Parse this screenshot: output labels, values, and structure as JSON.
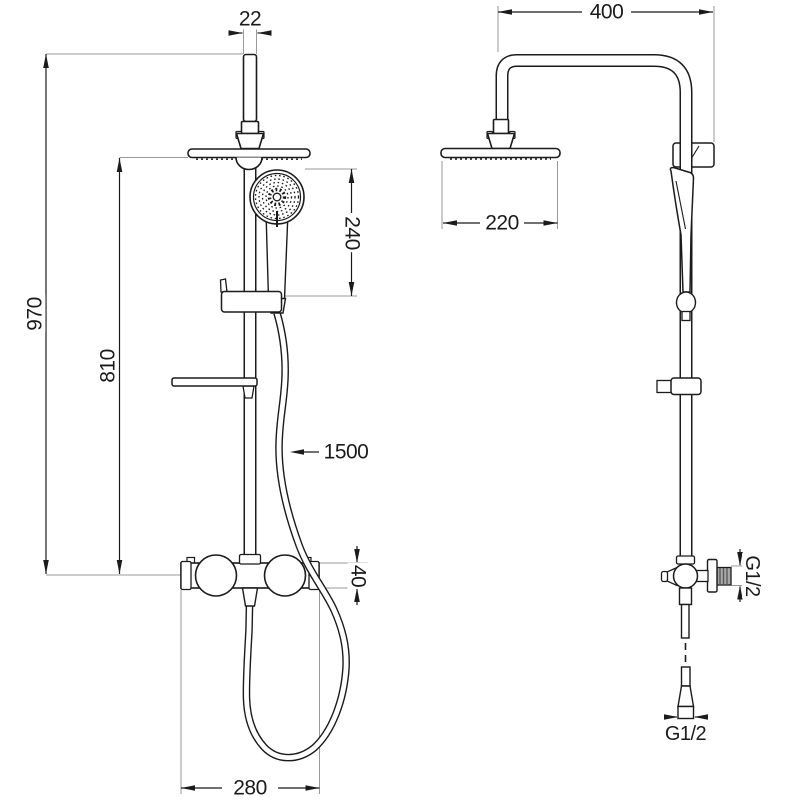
{
  "drawing": {
    "title": "Shower column technical drawing - front and side views",
    "style": {
      "ink": "#1b1b1b",
      "aux_line": "#999999",
      "background": "#ffffff"
    }
  },
  "front": {
    "pipe_diameter": "22",
    "total_height": "970",
    "rail_height": "810",
    "handshower_length": "240",
    "hose_length": "1500",
    "valve_height": "40",
    "valve_width": "280"
  },
  "side": {
    "arm_depth": "400",
    "head_diameter": "220",
    "inlet_thread": "G1/2",
    "hose_thread": "G1/2"
  }
}
